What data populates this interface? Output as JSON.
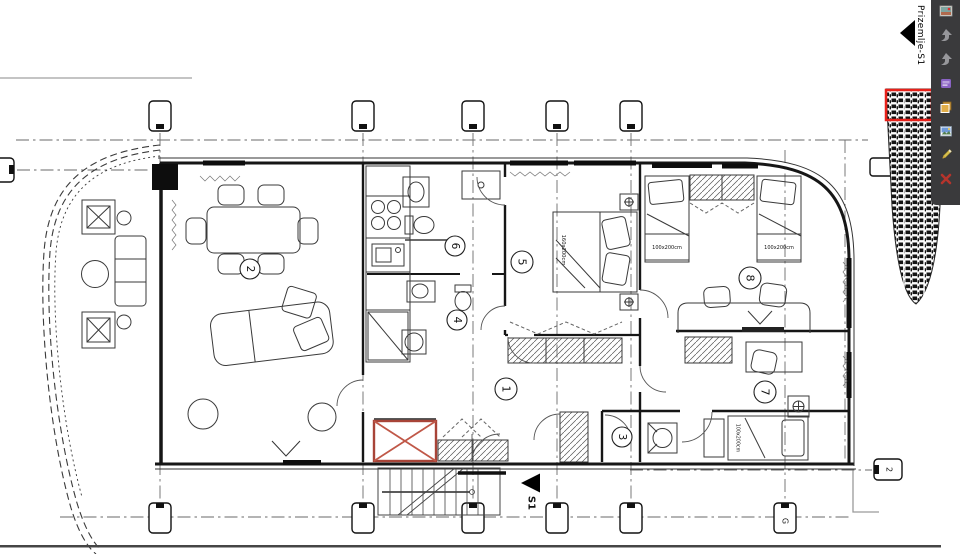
{
  "viewer": {
    "page_label": "Prizemlje-S1",
    "toolbar": {
      "background": "#3a3a3c",
      "icons": [
        {
          "name": "photo-icon"
        },
        {
          "name": "back-arrow-icon"
        },
        {
          "name": "back-arrow-2-icon"
        },
        {
          "name": "panel-icon"
        },
        {
          "name": "copy-icon"
        },
        {
          "name": "image-icon"
        },
        {
          "name": "pencil-icon"
        },
        {
          "name": "close-icon"
        }
      ]
    },
    "minimap": {
      "viewport_color": "#e8211a"
    }
  },
  "plan": {
    "rooms": [
      {
        "number": "1"
      },
      {
        "number": "2"
      },
      {
        "number": "3"
      },
      {
        "number": "4"
      },
      {
        "number": "5"
      },
      {
        "number": "6"
      },
      {
        "number": "7"
      },
      {
        "number": "8"
      }
    ],
    "labels": {
      "double_bed_size": "160x200cm",
      "single_bed_size": "100x200cm",
      "section_marker": "S1"
    },
    "grid": {
      "right_label": "2",
      "bottom_right_label": "G"
    },
    "colors": {
      "shaft_red": "#a84438",
      "shaft_cross": "#c05848"
    }
  }
}
